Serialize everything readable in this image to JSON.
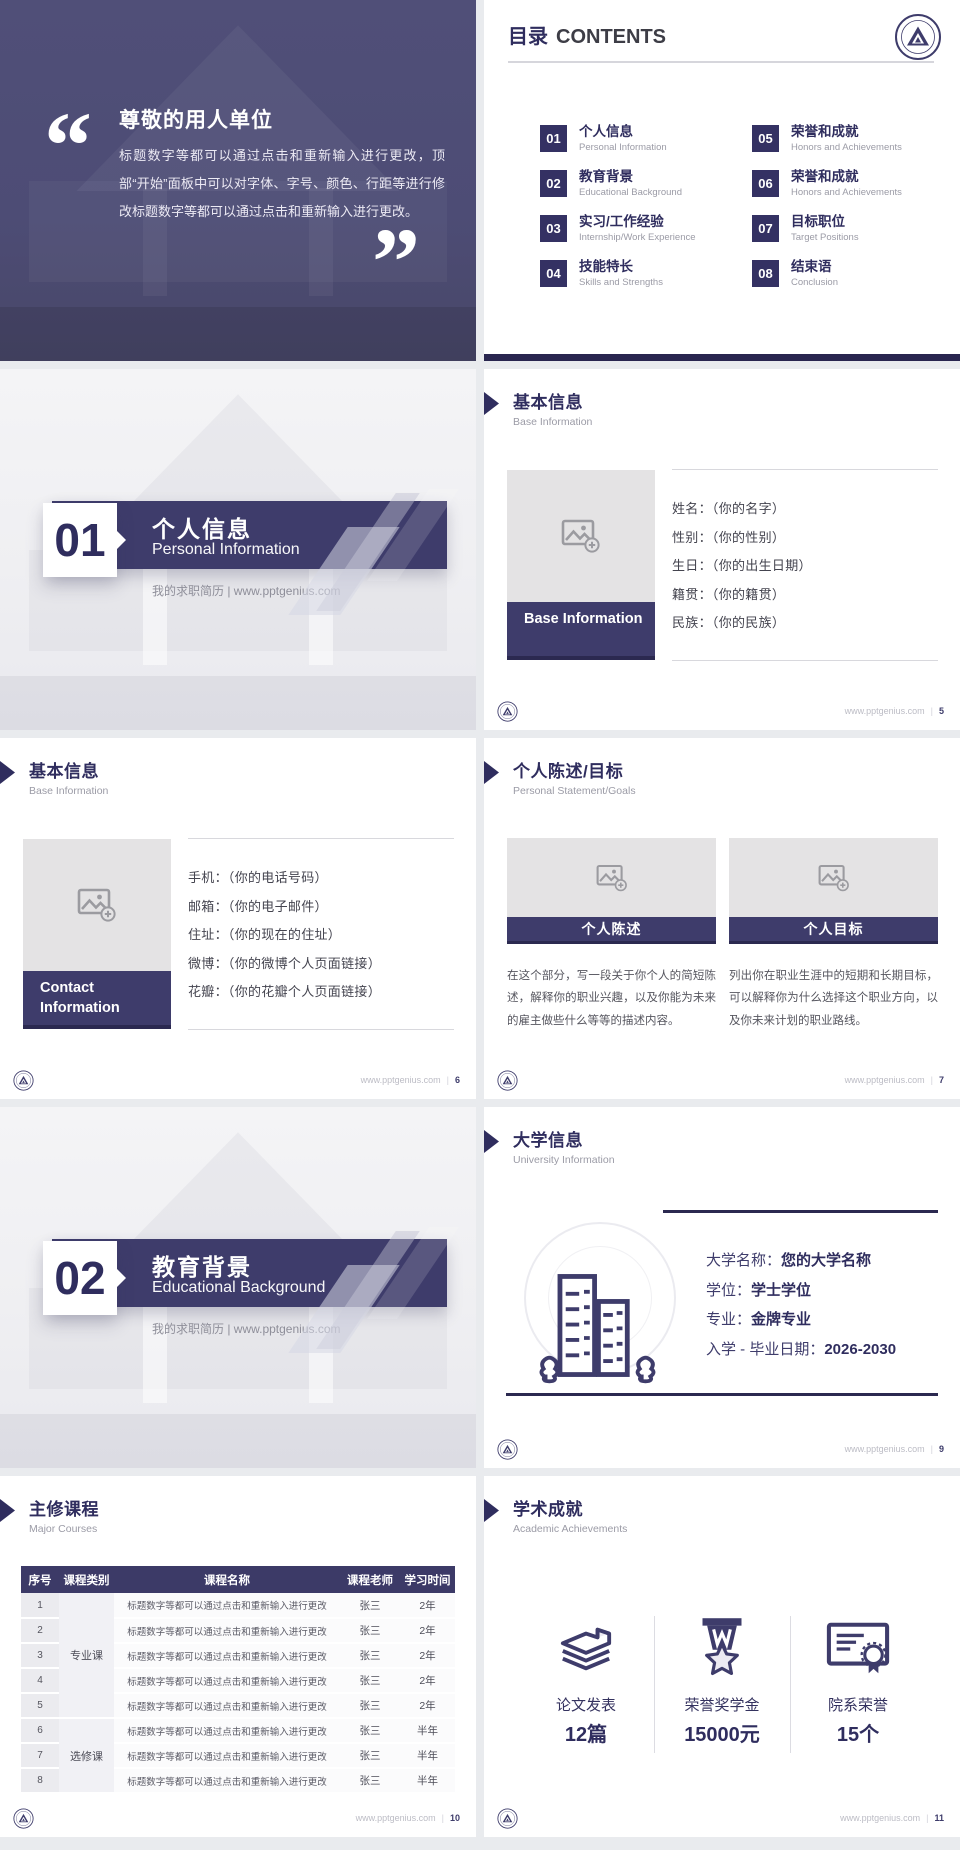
{
  "brand": {
    "site": "www.pptgenius.com",
    "divider": "|"
  },
  "quote": {
    "open_mark": "“",
    "close_mark": "”",
    "title": "尊敬的用人单位",
    "body": "标题数字等都可以通过点击和重新输入进行更改，顶部“开始”面板中可以对字体、字号、颜色、行距等进行修改标题数字等都可以通过点击和重新输入进行更改。"
  },
  "contents": {
    "title_zh": "目录",
    "title_en": "CONTENTS",
    "items": [
      {
        "num": "01",
        "zh": "个人信息",
        "en": "Personal Information"
      },
      {
        "num": "02",
        "zh": "教育背景",
        "en": "Educational Background"
      },
      {
        "num": "03",
        "zh": "实习/工作经验",
        "en": "Internship/Work Experience"
      },
      {
        "num": "04",
        "zh": "技能特长",
        "en": "Skills and Strengths"
      },
      {
        "num": "05",
        "zh": "荣誉和成就",
        "en": "Honors and Achievements"
      },
      {
        "num": "06",
        "zh": "荣誉和成就",
        "en": "Honors and Achievements"
      },
      {
        "num": "07",
        "zh": "目标职位",
        "en": "Target Positions"
      },
      {
        "num": "08",
        "zh": "结束语",
        "en": "Conclusion"
      }
    ]
  },
  "covers": [
    {
      "num": "01",
      "zh": "个人信息",
      "en": "Personal Information",
      "tagline": "我的求职简历 | www.pptgenius.com"
    },
    {
      "num": "02",
      "zh": "教育背景",
      "en": "Educational Background",
      "tagline": "我的求职简历 | www.pptgenius.com"
    }
  ],
  "base_info": {
    "header_zh": "基本信息",
    "header_en": "Base Information",
    "box_label": "Base Information",
    "fields": [
      "姓名：（你的名字）",
      "性别：（你的性别）",
      "生日：（你的出生日期）",
      "籍贯：（你的籍贯）",
      "民族：（你的民族）"
    ],
    "page": "5"
  },
  "contact_info": {
    "header_zh": "基本信息",
    "header_en": "Base Information",
    "box_label": "Contact Information",
    "fields": [
      "手机：（你的电话号码）",
      "邮箱：（你的电子邮件）",
      "住址：（你的现在的住址）",
      "微博：（你的微博个人页面链接）",
      "花瓣：（你的花瓣个人页面链接）"
    ],
    "page": "6"
  },
  "statement": {
    "header_zh": "个人陈述/目标",
    "header_en": "Personal Statement/Goals",
    "columns": [
      {
        "label": "个人陈述",
        "text": "在这个部分，写一段关于你个人的简短陈述，解释你的职业兴趣，以及你能为未来的雇主做些什么等等的描述内容。"
      },
      {
        "label": "个人目标",
        "text": "列出你在职业生涯中的短期和长期目标，可以解释你为什么选择这个职业方向，以及你未来计划的职业路线。"
      }
    ],
    "page": "7"
  },
  "university": {
    "header_zh": "大学信息",
    "header_en": "University Information",
    "fields": [
      {
        "label": "大学名称：",
        "value": "您的大学名称"
      },
      {
        "label": "学位：",
        "value": "学士学位"
      },
      {
        "label": "专业：",
        "value": "金牌专业"
      },
      {
        "label": "入学 - 毕业日期：",
        "value": "2026-2030"
      }
    ],
    "page": "9"
  },
  "courses": {
    "header_zh": "主修课程",
    "header_en": "Major Courses",
    "table": {
      "headers": [
        "序号",
        "课程类别",
        "课程名称",
        "课程老师",
        "学习时间"
      ],
      "categories": [
        {
          "label": "专业课"
        },
        {
          "label": "选修课"
        }
      ],
      "rows": [
        {
          "no": "1",
          "name": "标题数字等都可以通过点击和重新输入进行更改",
          "teacher": "张三",
          "duration": "2年"
        },
        {
          "no": "2",
          "name": "标题数字等都可以通过点击和重新输入进行更改",
          "teacher": "张三",
          "duration": "2年"
        },
        {
          "no": "3",
          "name": "标题数字等都可以通过点击和重新输入进行更改",
          "teacher": "张三",
          "duration": "2年"
        },
        {
          "no": "4",
          "name": "标题数字等都可以通过点击和重新输入进行更改",
          "teacher": "张三",
          "duration": "2年"
        },
        {
          "no": "5",
          "name": "标题数字等都可以通过点击和重新输入进行更改",
          "teacher": "张三",
          "duration": "2年"
        },
        {
          "no": "6",
          "name": "标题数字等都可以通过点击和重新输入进行更改",
          "teacher": "张三",
          "duration": "半年"
        },
        {
          "no": "7",
          "name": "标题数字等都可以通过点击和重新输入进行更改",
          "teacher": "张三",
          "duration": "半年"
        },
        {
          "no": "8",
          "name": "标题数字等都可以通过点击和重新输入进行更改",
          "teacher": "张三",
          "duration": "半年"
        }
      ]
    },
    "page": "10"
  },
  "achievements": {
    "header_zh": "学术成就",
    "header_en": "Academic Achievements",
    "stats": [
      {
        "icon": "papers-icon",
        "label": "论文发表",
        "value": "12篇"
      },
      {
        "icon": "medal-icon",
        "label": "荣誉奖学金",
        "value": "15000元"
      },
      {
        "icon": "certificate-icon",
        "label": "院系荣誉",
        "value": "15个"
      }
    ],
    "page": "11"
  }
}
